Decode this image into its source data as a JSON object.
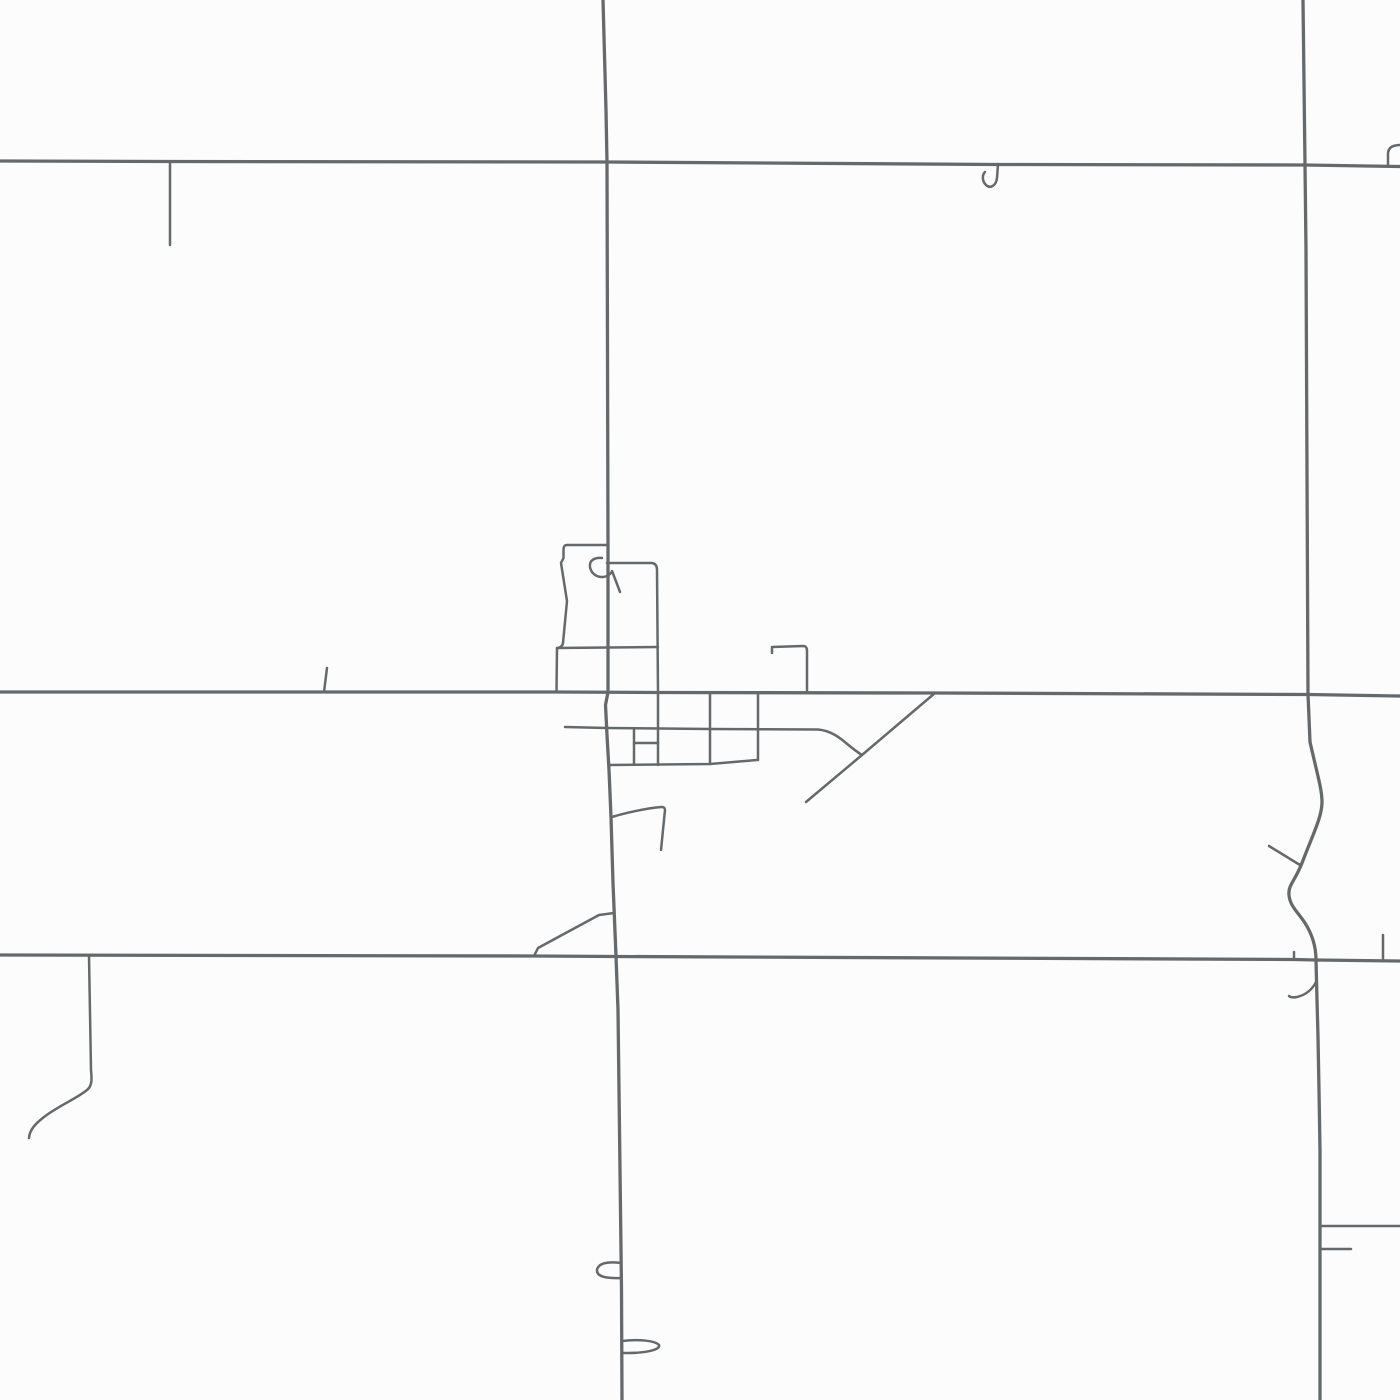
{
  "map": {
    "canvas": {
      "width": 1400,
      "height": 1400
    },
    "background_color": "#fcfcfc",
    "road_color": "#66696b",
    "layers": [
      {
        "name": "major-roads",
        "stroke_width": 3.3,
        "roads": [
          {
            "name": "road-top-horizontal",
            "d": "M0,161 L170,161.5 L607,162 L997,164.5 L1305,165 L1400,166.5"
          },
          {
            "name": "road-middle-horizontal",
            "d": "M0,692 L556,692 L658,692.5 L935,693 L1308,694.5 L1400,696"
          },
          {
            "name": "road-bottom-horizontal",
            "d": "M0,955 L534,956 L616,956.5 L1294,959.5 L1316,960 L1400,961"
          },
          {
            "name": "road-central-vertical",
            "d": "M603,0 L606,110 L607,162 L608,545 L608,692 L605.5,705 L607,735 L609,770 L611,817 L613,883 L616,956 L618,1010 L620,1170 L621.5,1290 L622,1400"
          },
          {
            "name": "road-right-vertical",
            "d": "M1303,0 L1305,165 L1306,250 L1308,694 L1310,742 C1318,777 1322,790 1322,802 C1322,817 1313,834 1302,863 C1295,881 1288,885 1289,895 C1290,906 1297,911 1305,923 C1312,934 1316,946 1316,960 L1317,1000 L1318,1037 L1319,1090 L1320,1150 L1320,1400"
          }
        ]
      },
      {
        "name": "minor-roads",
        "stroke_width": 2.5,
        "roads": [
          {
            "name": "stub-top-left",
            "d": "M170,162 L170,245"
          },
          {
            "name": "hook-j-north",
            "d": "M998,164 L997,178 C996,186 990,189 986,185 C982,181 982,175 985,172"
          },
          {
            "name": "hook-top-right",
            "d": "M1400,145 C1392,145 1388,148 1388,154 L1388,165"
          },
          {
            "name": "stub-middle-left",
            "d": "M327,668 L324,692"
          },
          {
            "name": "town-block-outline-left",
            "d": "M608,545 L567,545 C564,545 563.5,547 563.5,550 L563.5,558 L561,563 L567,601 L563,643 C562.5,646 560,648 557,648 L556.5,692"
          },
          {
            "name": "town-cross-street",
            "d": "M557,648 L608,647.5 L658,647"
          },
          {
            "name": "town-block-outline-right",
            "d": "M607,563 L651,563 C655,563 657,565.5 657,570 L658,692 L658,765"
          },
          {
            "name": "town-curl",
            "d": "M602,558 C594,557 589,561 590,567 C591,573 596,577 602,577 C607,577 611,574 612,571 C614,576 617,584 620,592"
          },
          {
            "name": "town-angle-east",
            "d": "M772,653 L772,647 L803,646 C806,646 807,647.5 807,651 L807,693"
          },
          {
            "name": "town-street-main",
            "d": "M565,727 L607,728 L710,729 L818,729.5 C830,730.5 839,737 846,743 C852,748 857,752 862,755"
          },
          {
            "name": "town-diagonal",
            "d": "M935,693 L862,755 L806,802"
          },
          {
            "name": "town-street-south",
            "d": "M610,765 L710,764 L757,760"
          },
          {
            "name": "town-street-vertical-a",
            "d": "M634,728.5 L634,764"
          },
          {
            "name": "town-street-mid",
            "d": "M634,743 L658,743"
          },
          {
            "name": "town-street-vertical-b",
            "d": "M710,693 L710,764"
          },
          {
            "name": "town-street-vertical-c",
            "d": "M758,693 L758,760"
          },
          {
            "name": "stub-flag-south",
            "d": "M612,817 C625,813 645,808.5 661,807 C664,806.8 665,808 665,810 L661,850"
          },
          {
            "name": "diagonal-shortcut",
            "d": "M534,956 L538,948 L599,915 L614,913"
          },
          {
            "name": "stub-curve-southwest",
            "d": "M89,956 L91,1070 C92,1080 92,1086 87,1090 C76,1099 58,1106 44,1117 C35,1124 29.5,1130 29,1138"
          },
          {
            "name": "loop-west",
            "d": "M621,1263 C607,1261 598,1263.5 597,1270 C596.5,1277 607,1278.5 621,1278"
          },
          {
            "name": "loop-east",
            "d": "M622,1341 C638,1339 655,1340.5 659,1345 C661,1350 644,1353.5 623,1353"
          },
          {
            "name": "tick-above-bottom-road",
            "d": "M1294,952 L1294,959.5"
          },
          {
            "name": "stub-above-bottom-road",
            "d": "M1383,935 L1383,960"
          },
          {
            "name": "spur-wiggle",
            "d": "M1269,846 L1300,865"
          },
          {
            "name": "hook-below-bottom-road",
            "d": "M1316,982 C1312,990 1305,995 1297,997 C1292,998 1290,997 1289,996"
          },
          {
            "name": "branch-southeast",
            "d": "M1320,1226 L1400,1226"
          },
          {
            "name": "stub-southeast",
            "d": "M1320,1249 L1351,1249"
          }
        ]
      }
    ]
  }
}
